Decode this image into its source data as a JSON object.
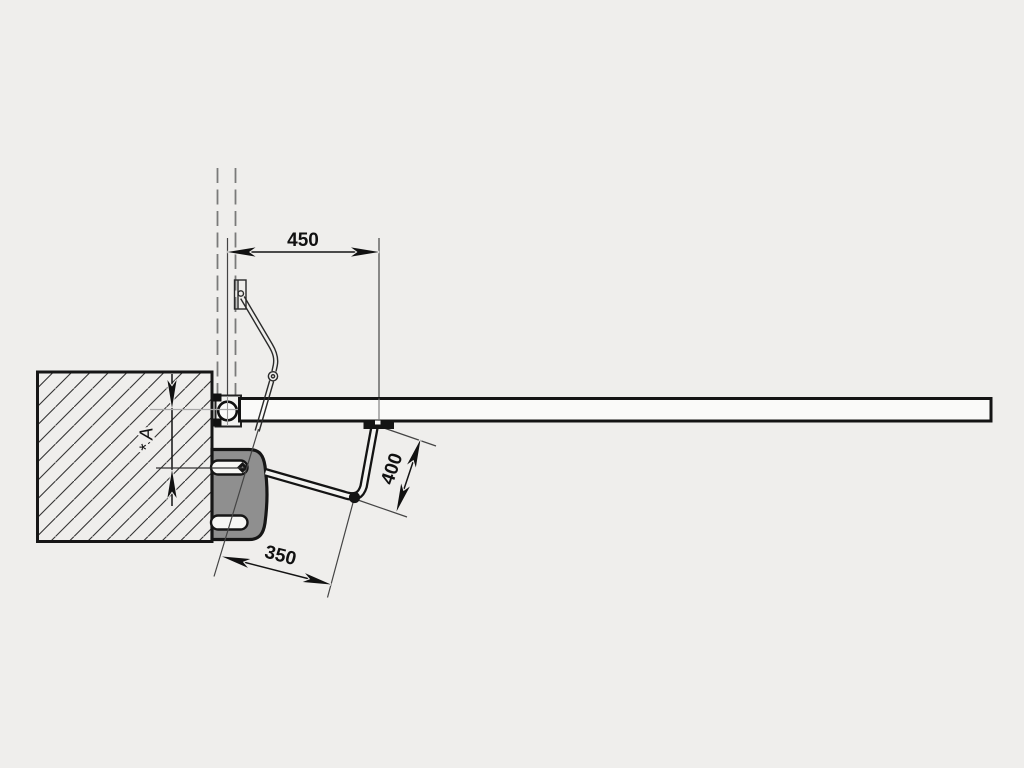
{
  "drawing": {
    "description": "Swing gate articulated-arm operator installation diagram, top view",
    "dimensions": {
      "top": {
        "value": "450"
      },
      "arm": {
        "value": "400"
      },
      "bottom": {
        "value": "350"
      },
      "reserve": {
        "value": "* A"
      }
    },
    "colors": {
      "background": "#efeeec",
      "line": "#141414",
      "bracket_fill": "#8f8f8f",
      "gate_fill": "#fafaf9",
      "centerline": "#7a7a7a"
    }
  }
}
